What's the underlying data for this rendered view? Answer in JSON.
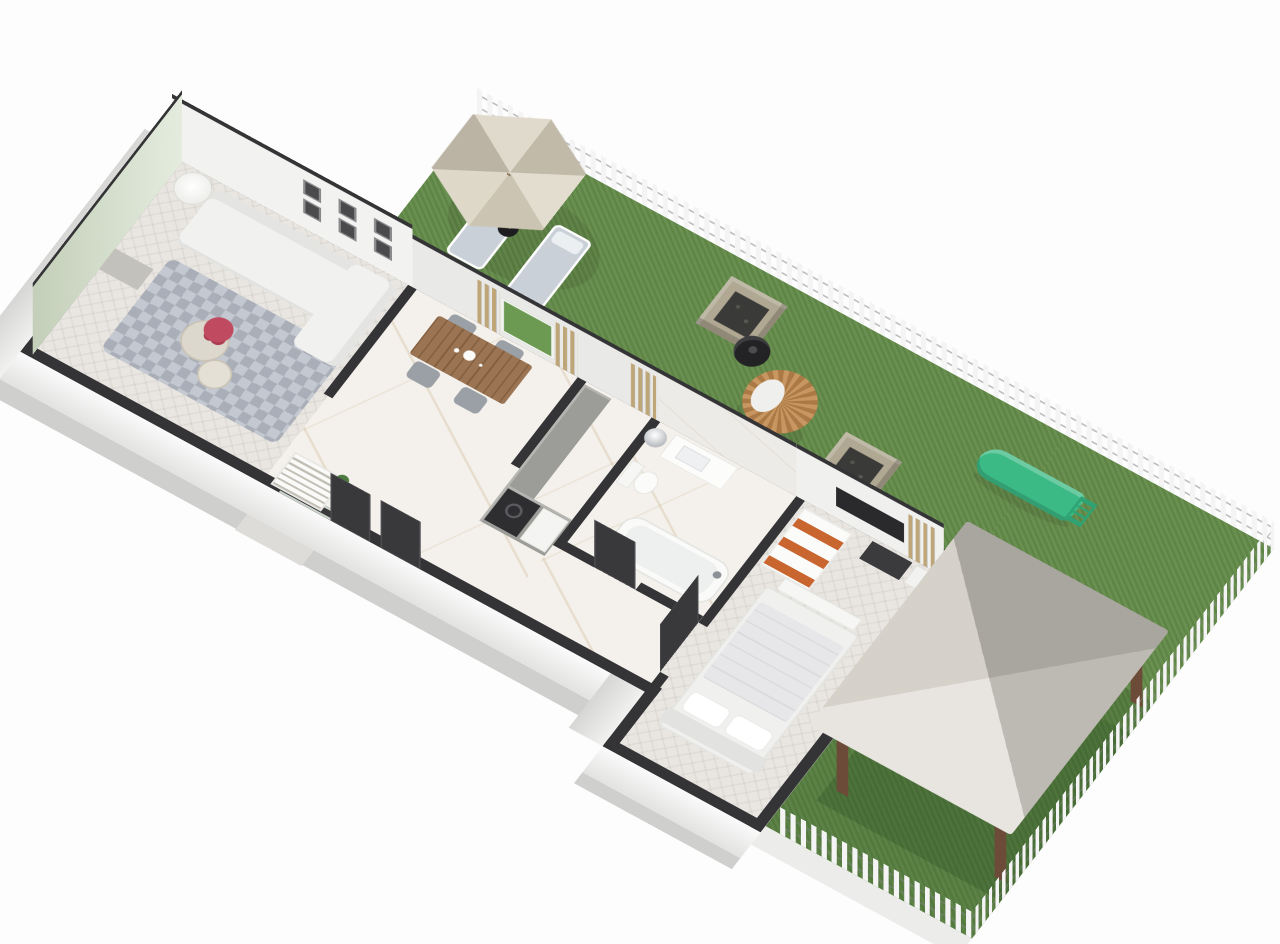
{
  "meta": {
    "description": "isometric 3d floor plan rendering of a long one-bedroom home with fenced backyard"
  },
  "palette": {
    "background": "#fdfdfd",
    "lawn": "#648c4a",
    "lawn_dark": "#4e7a3c",
    "wall_top": "#343437",
    "wall_face": "#f2f2f0",
    "accent_wall": "#cfdcc4",
    "fence": "#f4f4f4",
    "railing": "#2c2c2e",
    "curtain": "#bfa678",
    "marble_floor": "#f4f1ec",
    "wood_floor": "#e9e6e1",
    "wood_table": "#936a46",
    "chair_gray": "#9aa0a5",
    "sofa": "#f1f1ef",
    "rug": "#b4b9c3",
    "umbrella": "#d7cfbc",
    "lounger_cushion": "#c9d0d7",
    "fire_pit": "#b0a892",
    "grill": "#232325",
    "egg_chair": "#c28a4e",
    "slide": "#3cba85",
    "gazebo_roof": "#dedad2",
    "gazebo_post": "#6d4b39",
    "towels": "#c9652f",
    "bed": "#f0f0ee",
    "tv": "#2a2a2d",
    "flowers": "#c04a60",
    "counter": "#9c9c98",
    "appliance": "#2e2e31",
    "door": "#39393c"
  },
  "scene": {
    "view": "isometric-3d-floorplan",
    "rooms": [
      "living-room",
      "dining-area",
      "kitchen",
      "bathroom",
      "bedroom",
      "entry",
      "backyard-lawn",
      "gazebo-patio"
    ],
    "outdoor_items": [
      "picket-fence",
      "parasol",
      "sun-lounger",
      "sun-lounger",
      "fire-pit",
      "fire-pit",
      "kettle-grill",
      "hanging-egg-chair",
      "kids-slide",
      "metal-railing",
      "gazebo",
      "round-patio-table"
    ],
    "indoor_items": [
      "corner-sofa",
      "floor-lamp",
      "gallery-frames",
      "area-rug",
      "coffee-tables",
      "flower-vase",
      "dining-table",
      "dining-chairs",
      "shoe-cabinet",
      "kitchen-counter",
      "washing-machine",
      "vanity-sink",
      "wall-mirror-light",
      "toilet",
      "bathtub",
      "towel-shelf",
      "wardrobe",
      "double-bed",
      "bed-bench",
      "tv-panel",
      "curtains",
      "interior-doors"
    ]
  }
}
